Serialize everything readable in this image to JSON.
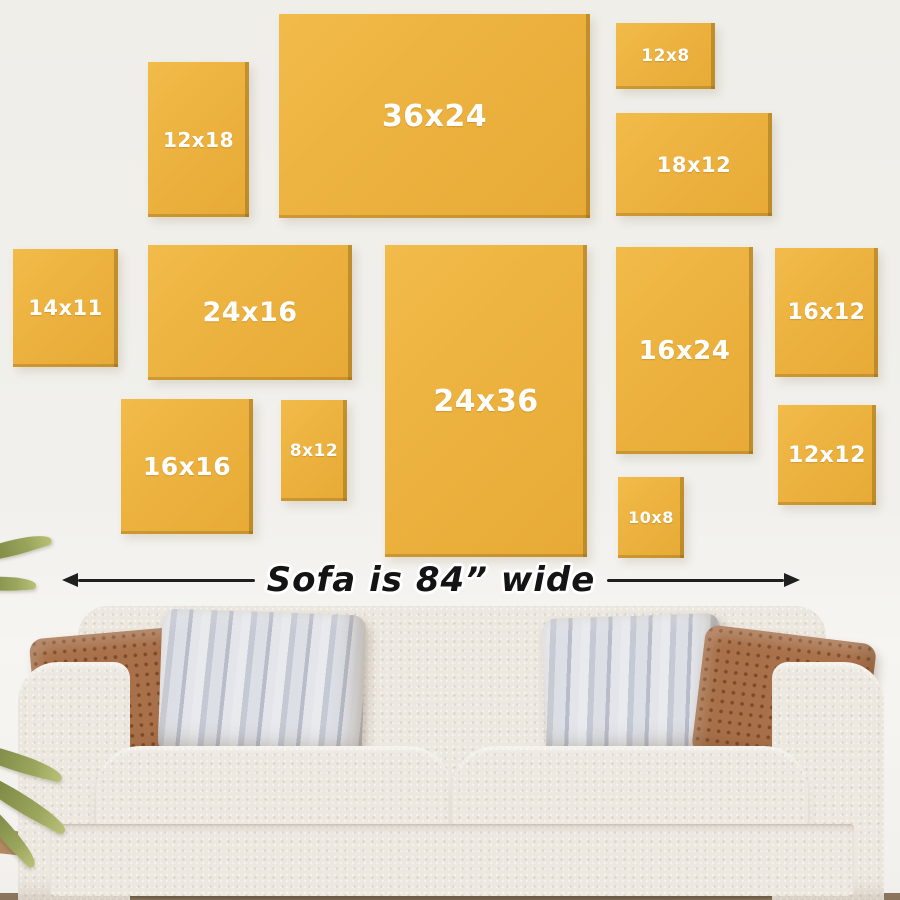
{
  "scene": {
    "wall_color": "#F0EFEA",
    "frame_color": "#ECB13E",
    "frame_edge_color": "#9E7418",
    "frame_label_color": "#FFFFFF",
    "arrow_color": "#1F1F1F",
    "sofa_color": "#ECE6DE",
    "pillow_brown_color": "#A9714A",
    "pillow_stripe_color": "#C9CDD7",
    "plant_color": "#84904A",
    "floor_color": "#B28A63"
  },
  "frames": [
    {
      "label": "12x18",
      "x": 148,
      "y": 62,
      "w": 101,
      "h": 155,
      "font": 20
    },
    {
      "label": "36x24",
      "x": 279,
      "y": 14,
      "w": 311,
      "h": 204,
      "font": 30
    },
    {
      "label": "12x8",
      "x": 616,
      "y": 23,
      "w": 99,
      "h": 66,
      "font": 17
    },
    {
      "label": "18x12",
      "x": 616,
      "y": 113,
      "w": 156,
      "h": 103,
      "font": 21
    },
    {
      "label": "14x11",
      "x": 13,
      "y": 249,
      "w": 105,
      "h": 118,
      "font": 21
    },
    {
      "label": "24x16",
      "x": 148,
      "y": 245,
      "w": 204,
      "h": 135,
      "font": 27
    },
    {
      "label": "24x36",
      "x": 385,
      "y": 245,
      "w": 202,
      "h": 312,
      "font": 30
    },
    {
      "label": "16x24",
      "x": 616,
      "y": 247,
      "w": 137,
      "h": 207,
      "font": 26
    },
    {
      "label": "16x12",
      "x": 775,
      "y": 248,
      "w": 103,
      "h": 129,
      "font": 22
    },
    {
      "label": "16x16",
      "x": 121,
      "y": 399,
      "w": 132,
      "h": 135,
      "font": 25
    },
    {
      "label": "8x12",
      "x": 281,
      "y": 400,
      "w": 66,
      "h": 101,
      "font": 17
    },
    {
      "label": "10x8",
      "x": 618,
      "y": 477,
      "w": 66,
      "h": 81,
      "font": 16
    },
    {
      "label": "12x12",
      "x": 778,
      "y": 405,
      "w": 98,
      "h": 100,
      "font": 22
    }
  ],
  "measure": {
    "label": "Sofa is 84” wide"
  }
}
